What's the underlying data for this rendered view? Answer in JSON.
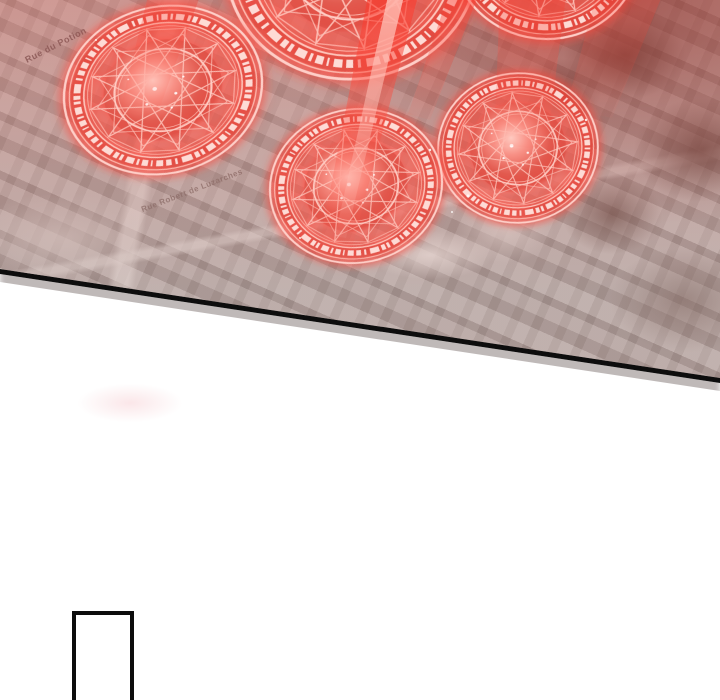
{
  "page": {
    "type": "webtoon comic page",
    "background_color": "#ffffff"
  },
  "panel_map": {
    "description": "Aerial satellite view of a town overlaid with five glowing red magic summoning circles and descending red light beams; panel bottom edge is slanted with a black border",
    "street_labels": [
      {
        "text": "Rue du Potion"
      },
      {
        "text": "Rue Robert de Luzarches"
      }
    ],
    "magic_circle_count": 5,
    "colors": {
      "glow_red": "#ff4a3c",
      "ring_light": "#ffd9d3",
      "map_base": "#b5a7a4",
      "tree_dark": "#6a4f49",
      "border_black": "#0d0d0d"
    }
  },
  "next_panel": {
    "content": ""
  }
}
